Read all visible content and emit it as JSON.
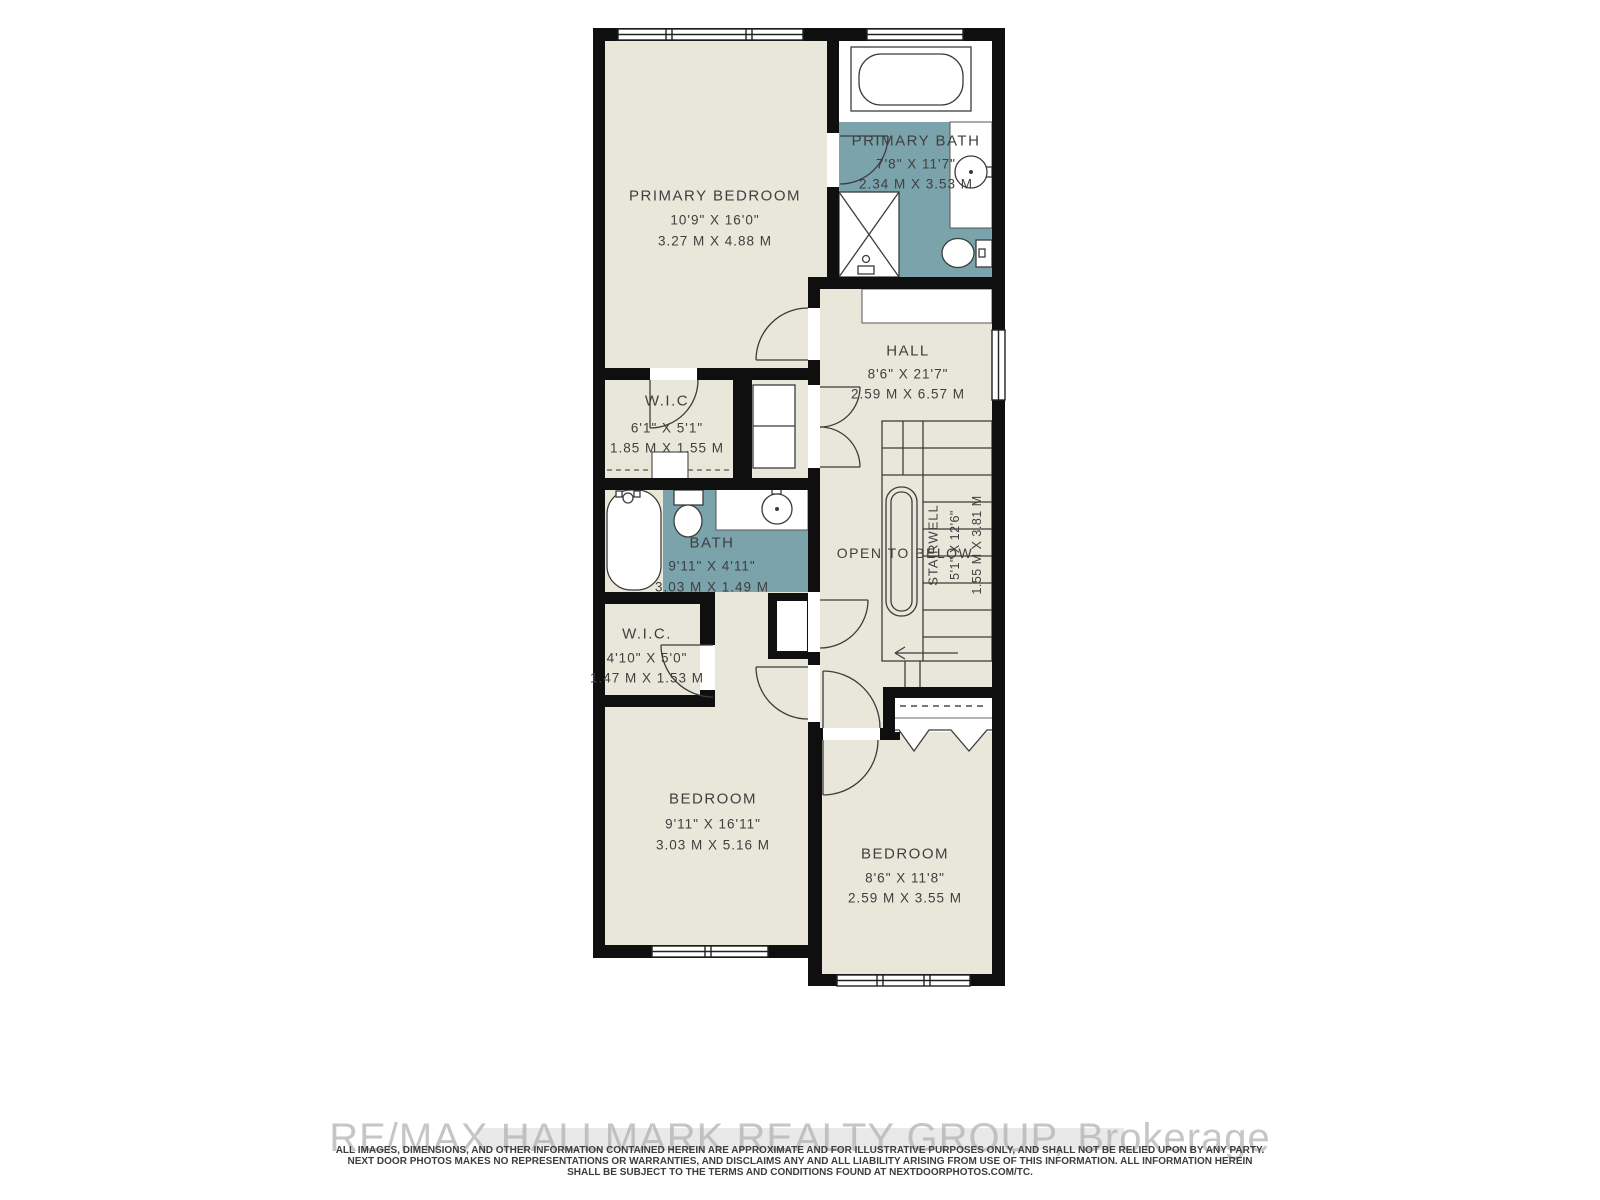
{
  "floorplan": {
    "rooms": {
      "primary_bedroom": {
        "name": "PRIMARY BEDROOM",
        "imperial": "10'9\" X 16'0\"",
        "metric": "3.27 M X 4.88 M"
      },
      "primary_bath": {
        "name": "PRIMARY BATH",
        "imperial": "7'8\" X 11'7\"",
        "metric": "2.34 M X 3.53 M"
      },
      "wic_upper": {
        "name": "W.I.C",
        "imperial": "6'1\" X 5'1\"",
        "metric": "1.85 M X 1.55 M"
      },
      "hall": {
        "name": "HALL",
        "imperial": "8'6\" X 21'7\"",
        "metric": "2.59 M X 6.57 M"
      },
      "bath": {
        "name": "BATH",
        "imperial": "9'11\" X 4'11\"",
        "metric": "3.03 M X 1.49 M"
      },
      "wic_lower": {
        "name": "W.I.C.",
        "imperial": "4'10\" X 5'0\"",
        "metric": "1.47 M X 1.53 M"
      },
      "stairwell": {
        "name": "STAIRWELL",
        "imperial": "5'1\" X 12'6\"",
        "metric": "1.55 M X 3.81 M"
      },
      "open_to_below": {
        "label": "OPEN TO BELOW"
      },
      "bedroom_left": {
        "name": "BEDROOM",
        "imperial": "9'11\" X 16'11\"",
        "metric": "3.03 M X 5.16 M"
      },
      "bedroom_right": {
        "name": "BEDROOM",
        "imperial": "8'6\" X 11'8\"",
        "metric": "2.59 M X 3.55 M"
      }
    },
    "colors": {
      "floor": "#e9e6da",
      "bath_floor": "#7aa3ab",
      "wall": "#0f0f0f",
      "line": "#3c3c3c",
      "label_text": "#3f3f3f"
    }
  },
  "footer": {
    "watermark": "RE/MAX HALLMARK REALTY GROUP, Brokerage",
    "disclaimer": [
      "ALL IMAGES, DIMENSIONS, AND OTHER INFORMATION CONTAINED HEREIN ARE APPROXIMATE AND FOR ILLUSTRATIVE PURPOSES ONLY, AND SHALL NOT BE RELIED UPON BY ANY PARTY.",
      "NEXT DOOR PHOTOS MAKES NO REPRESENTATIONS OR WARRANTIES, AND DISCLAIMS ANY AND ALL LIABILITY ARISING FROM USE OF THIS INFORMATION. ALL INFORMATION HEREIN",
      "SHALL BE SUBJECT TO THE TERMS AND CONDITIONS FOUND AT NEXTDOORPHOTOS.COM/TC."
    ]
  }
}
